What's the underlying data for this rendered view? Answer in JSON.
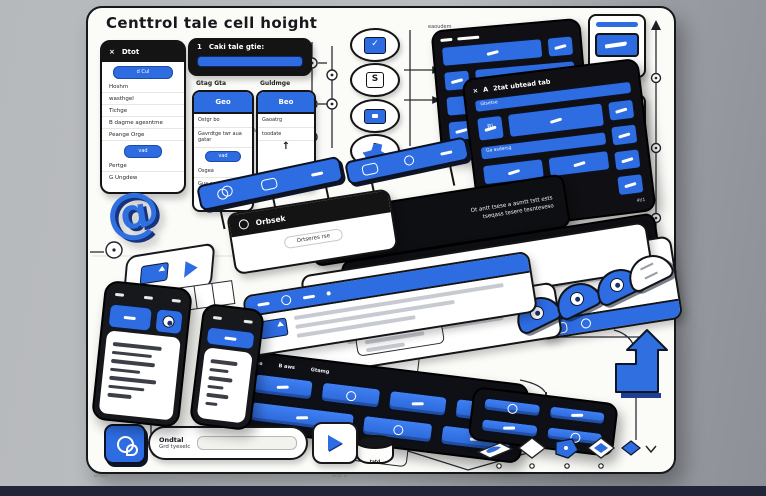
{
  "title": "Centtrol tale cell hoight",
  "captions": {
    "left": "orton",
    "center": "etot a",
    "right": "anrte tact tn eansteaer"
  },
  "icons": {
    "close": "×",
    "check": "✓",
    "letter_s": "S",
    "up_arrow": "↑",
    "at": "@"
  },
  "detail_panel": {
    "title": "Dtot",
    "top_pill": "d Cul",
    "items": [
      "Hoshm",
      "wasthgel",
      "Tichge",
      "B dagme agesntme",
      "Peange Orge"
    ],
    "mid_pill": "vad",
    "footer_items": [
      "Pertge",
      "G Ungdew"
    ]
  },
  "cell_panel": {
    "num": "1",
    "title": "Caki tale gtie:",
    "col_left": "Gtag Gta",
    "col_right": "Guldmge"
  },
  "geo_card": {
    "header": "Geo",
    "line1": "Ostgr bo",
    "line2": "Gavrdtge twr aua gatar",
    "pill": "vad",
    "line3": "Osgea",
    "line4": "Gua aad hatad g ad"
  },
  "beo_card": {
    "header": "Beo",
    "line1": "Gaoatrg",
    "line2": "toodate"
  },
  "labels": {
    "flow": "tasdatdtag",
    "stream": "eaoudem"
  },
  "dark_panel": {
    "prefix": "A",
    "title": "2tat ubtead tab",
    "search": "Gtsetse",
    "cell": "Bl",
    "bar": "Ga asdersg",
    "corner": "4tl1"
  },
  "banner1": {
    "line1": "Ot antt tsese a asmtt tstt ests",
    "line2": "tseqass tesere tesnteseso"
  },
  "orbsek": {
    "title": "Orbsek",
    "body": "Ortseres rse"
  },
  "banner2": {
    "line1": "Tstetss ts asesste tstse etsetsrstets ssts anesetse",
    "line2": "tsetsstse tstsetse ttse oetsetse ssetse tstsr astseter",
    "line3": "sestse tstse etstse tsetsrse",
    "cells": [
      "Htsy",
      "Grtao",
      "Wts"
    ]
  },
  "notice": {
    "line1": "Tsetsersse ts asetse tsese esetsrstets ssts anesetse",
    "line2": "tstsetse ttse oetsetse ssetse tstsr astseter sestse",
    "line3": "tsetse tstse etstse etsets tsetsrse"
  },
  "keyboard": {
    "labels": [
      "Ba",
      "B aws",
      "Gtamg"
    ]
  },
  "cylinder": {
    "label": "tatd"
  },
  "search": {
    "title": "Ondtal",
    "subtitle": "Grd tyeselc"
  }
}
